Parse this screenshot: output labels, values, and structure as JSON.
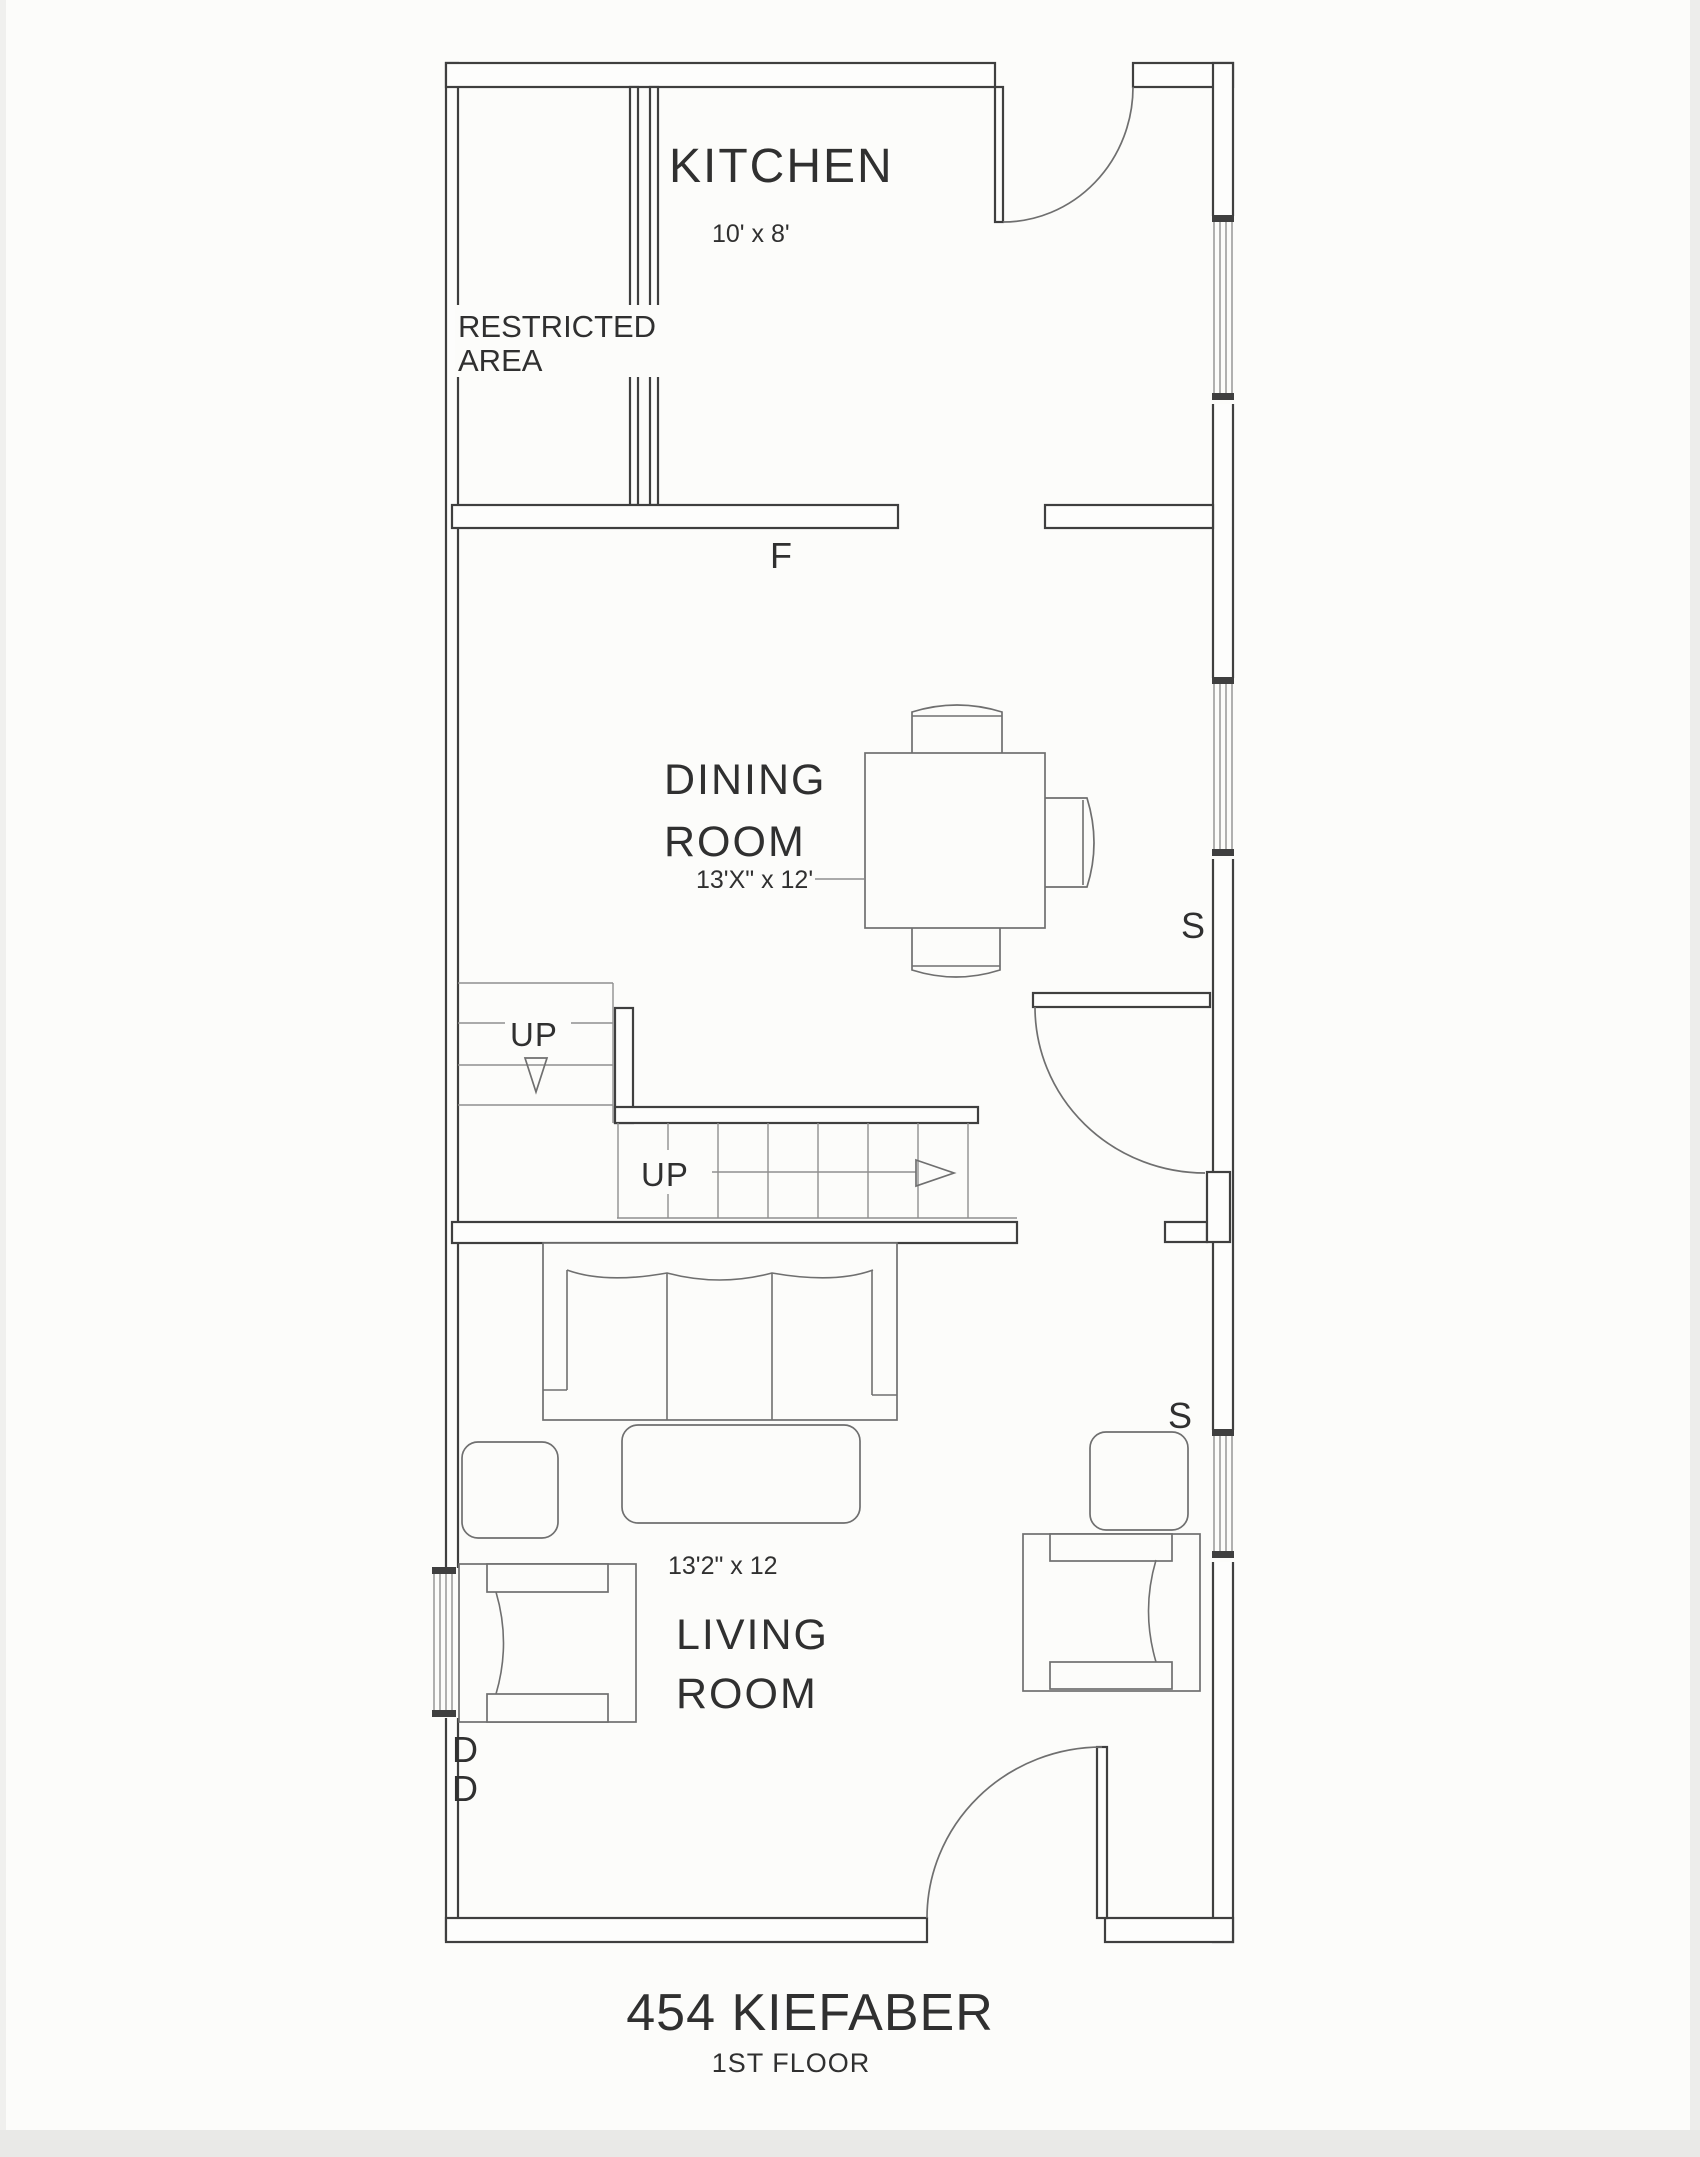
{
  "rooms": {
    "kitchen": {
      "name": "KITCHEN",
      "dims": "10' x 8'"
    },
    "restricted": {
      "line1": "RESTRICTED",
      "line2": "AREA"
    },
    "dining": {
      "line1": "DINING",
      "line2": "ROOM",
      "dims": "13'X\" x 12'"
    },
    "living": {
      "line1": "LIVING",
      "line2": "ROOM",
      "dims": "13'2\" x 12"
    }
  },
  "stairs": {
    "upper_label": "UP",
    "lower_label": "UP"
  },
  "markers": {
    "furnace": "F",
    "switch_dining": "S",
    "switch_living": "S",
    "door_1": "D",
    "door_2": "D"
  },
  "footer": {
    "address": "454 KIEFABER",
    "floor": "1ST FLOOR"
  },
  "colors": {
    "wall_line": "#3f3f3f",
    "furniture_line": "#6f6f6f",
    "paper": "#fcfcfa",
    "text": "#303030"
  }
}
